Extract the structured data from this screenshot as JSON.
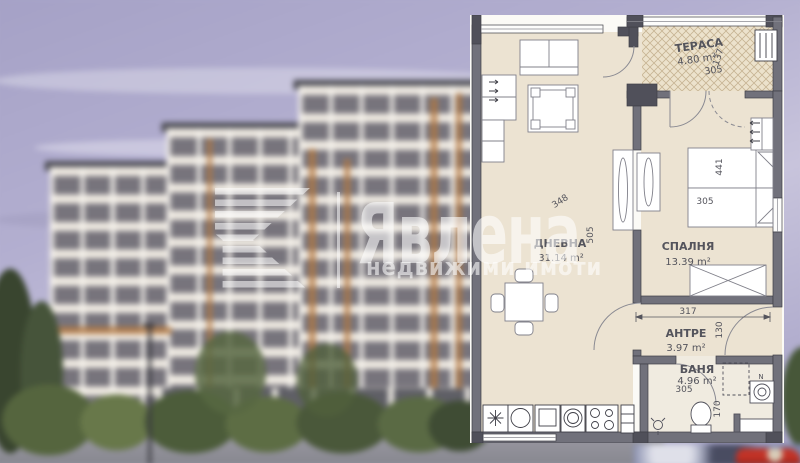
{
  "watermark": {
    "brand": "Явлена",
    "tagline": "недвижими имоти"
  },
  "plan": {
    "rooms": {
      "terrace": {
        "name": "ТЕРАСА",
        "area": "4.80 m²"
      },
      "living": {
        "name": "ДНЕВНА",
        "area": "31.14 m²"
      },
      "bedroom": {
        "name": "СПАЛНЯ",
        "area": "13.39 m²"
      },
      "hall": {
        "name": "АНТРЕ",
        "area": "3.97 m²"
      },
      "bath": {
        "name": "БАНЯ",
        "area": "4.96 m²"
      }
    },
    "dims": {
      "terrace_width": "305",
      "terrace_depth": "137",
      "living_width": "348",
      "living_depth": "505",
      "bed_length": "441",
      "bed_width": "305",
      "hall_width": "317",
      "hall_depth": "130",
      "bath_width": "305",
      "bath_depth": "170"
    },
    "marks": {
      "niche": "N"
    }
  },
  "colors": {
    "sky": "#b3afd0",
    "wall": "#71717b",
    "wall_dark": "#50505a",
    "floor": "#ece3d2",
    "terrace_hatch": "#c7b494",
    "watermark": "rgba(255,255,255,0.58)",
    "car_red": "#c23327"
  }
}
